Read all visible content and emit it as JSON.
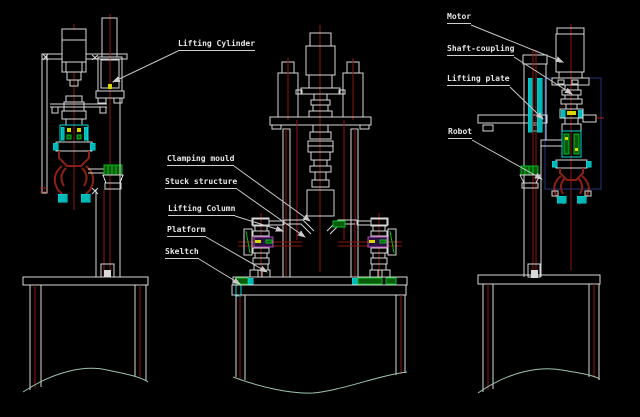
{
  "canvas": {
    "width": 640,
    "height": 417,
    "background": "#000000"
  },
  "colors": {
    "outline": "#d8d8d8",
    "centerline_red": "#8a1810",
    "claw_red": "#8c2016",
    "break_line_green": "#9cc4ac",
    "detail_cyan": "#00d8d8",
    "detail_green": "#00c020",
    "detail_yellow": "#d8d800",
    "detail_magenta": "#b44cb4",
    "frame_navy": "#25357a",
    "label_text": "#e6e6e6"
  },
  "labels": {
    "lifting_cylinder": "Lifting Cylinder",
    "clamping_mould": "Clamping mould",
    "stuck_structure": "Stuck structure",
    "lifting_column": "Lifting Column",
    "platform": "Platform",
    "skeltch": "Skeltch",
    "motor": "Motor",
    "shaft_coupling": "Shaft-coupling",
    "lifting_plate": "Lifting plate",
    "robot": "Robot"
  }
}
